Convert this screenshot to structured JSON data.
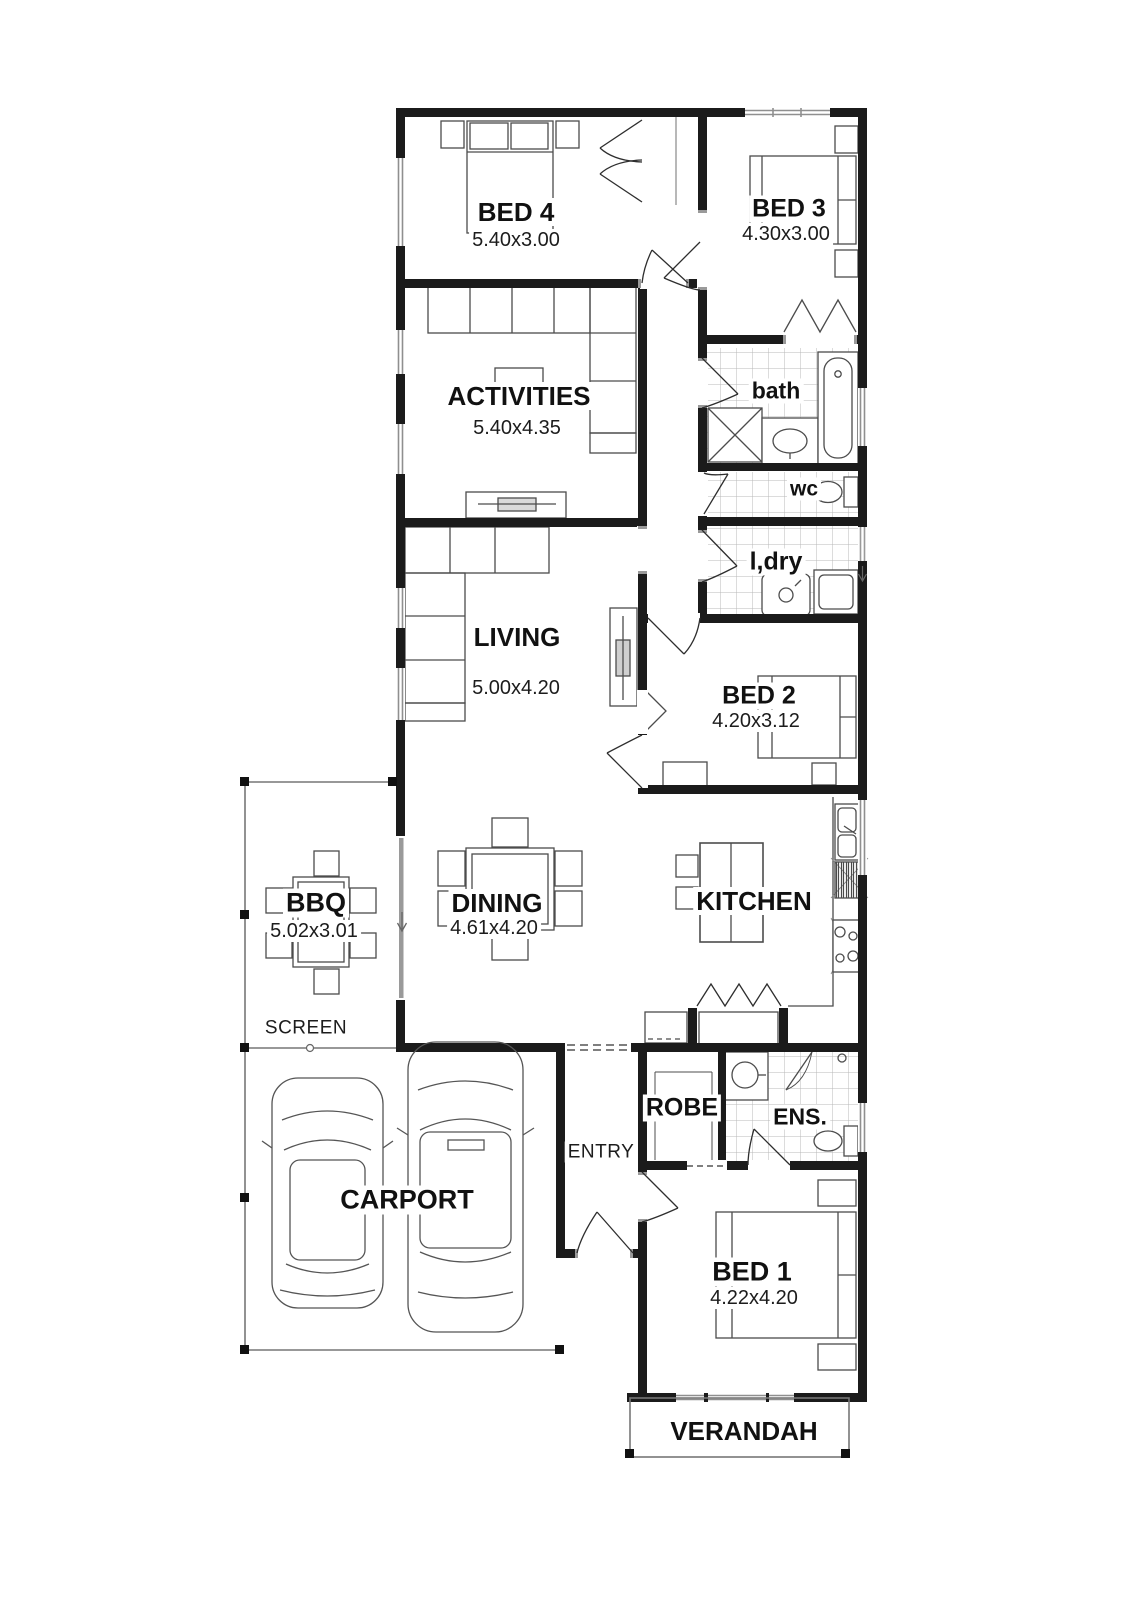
{
  "rooms": {
    "bed4": {
      "name": "BED 4",
      "dims": "5.40x3.00"
    },
    "bed3": {
      "name": "BED 3",
      "dims": "4.30x3.00"
    },
    "activities": {
      "name": "ACTIVITIES",
      "dims": "5.40x4.35"
    },
    "bath": {
      "name": "bath"
    },
    "wc": {
      "name": "wc"
    },
    "laundry": {
      "name": "l,dry"
    },
    "living": {
      "name": "LIVING",
      "dims": "5.00x4.20"
    },
    "bed2": {
      "name": "BED 2",
      "dims": "4.20x3.12"
    },
    "bbq": {
      "name": "BBQ",
      "dims": "5.02x3.01"
    },
    "dining": {
      "name": "DINING",
      "dims": "4.61x4.20"
    },
    "kitchen": {
      "name": "KITCHEN"
    },
    "screen": {
      "name": "SCREEN"
    },
    "entry": {
      "name": "ENTRY"
    },
    "robe": {
      "name": "ROBE"
    },
    "ensuite": {
      "name": "ENS."
    },
    "carport": {
      "name": "CARPORT"
    },
    "bed1": {
      "name": "BED 1",
      "dims": "4.22x4.20"
    },
    "verandah": {
      "name": "VERANDAH"
    }
  },
  "colors": {
    "wall": "#1b1b1b",
    "furniture": "#4c4c4c",
    "tile": "#b9b9b9",
    "window": "#8f8f8f",
    "background": "#ffffff"
  }
}
